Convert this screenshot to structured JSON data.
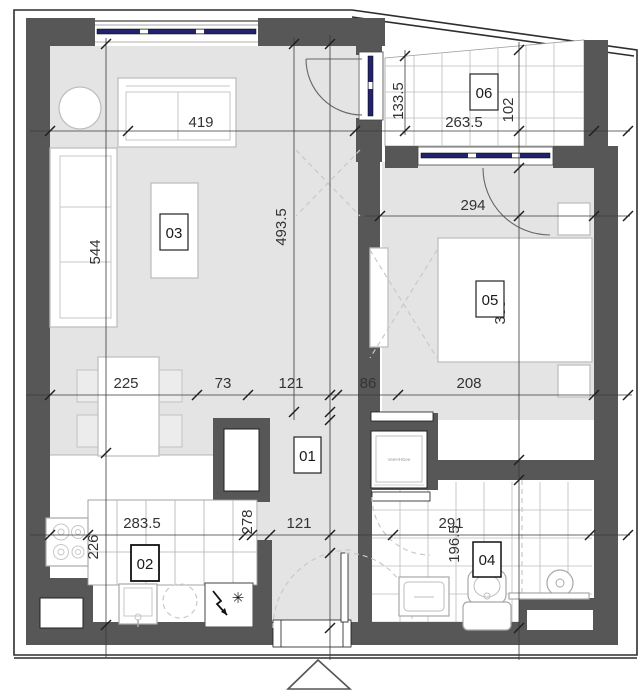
{
  "rooms": {
    "r01": "01",
    "r02": "02",
    "r03": "03",
    "r04": "04",
    "r05": "05",
    "r06": "06"
  },
  "dimensions": {
    "living_width": "419",
    "living_height": "544",
    "center_height": "493.5",
    "terrace_height_left": "133.5",
    "terrace_width": "263.5",
    "terrace_height_right": "102",
    "bedroom_width": "294",
    "bedroom_height": "389",
    "dining_width": "225",
    "gap_width": "73",
    "hall_width_top": "121",
    "bedroom_entry_width": "86",
    "bed_zone_width": "208",
    "kitchen_width": "283.5",
    "kitchen_depth": "226",
    "hall_length": "278",
    "hall_width_bottom": "121",
    "bathroom_width": "291",
    "bathroom_height": "196.5"
  },
  "appliance_labels": {
    "washer": "VeeHHGee"
  },
  "icons": {
    "freezer_star": "✳"
  },
  "colors": {
    "wall": "#575757",
    "floor": "#e4e4e4",
    "glazing": "#22226e"
  }
}
